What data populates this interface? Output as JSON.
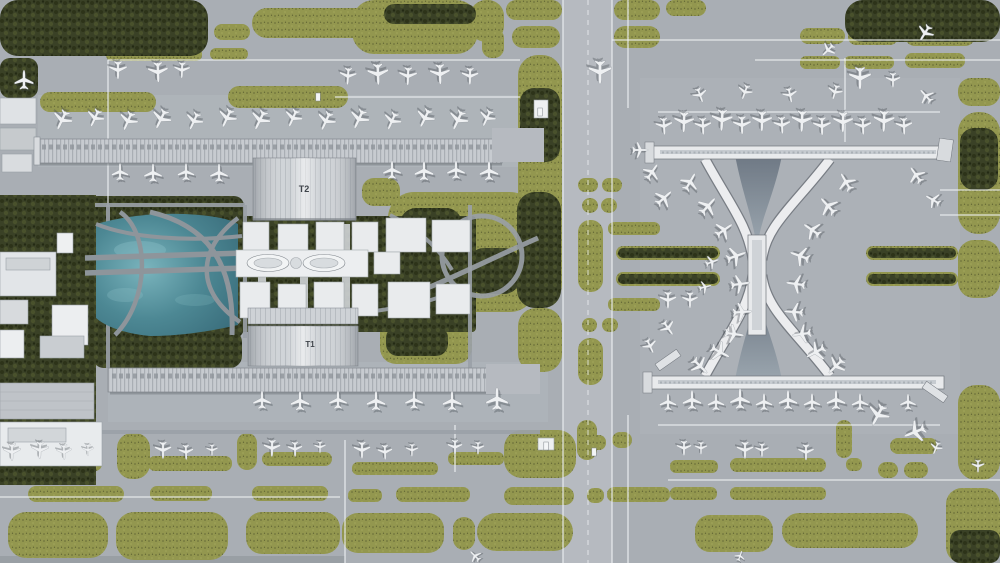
{
  "scene": {
    "title": "Aerial satellite view of airport with twin linear concourses and dog-bone terminal",
    "width": 1000,
    "height": 563
  },
  "labels": {
    "t2": "T2",
    "t1": "T1"
  },
  "colors": {
    "apron": "#a9aeb4",
    "apron_light": "#b2b7bd",
    "grass": "#93974f",
    "trees": "#3a4126",
    "water": "#4d8894",
    "terminal_roof": "#e8eaec",
    "pier_roof": "#c7cbd0",
    "taxiline": "#eef1f3",
    "road": "#9ba1a8",
    "shadow": "#70757c"
  },
  "grass_patches": [
    [
      112,
      24,
      88,
      18,
      9
    ],
    [
      214,
      24,
      36,
      16,
      8
    ],
    [
      252,
      8,
      124,
      30,
      15
    ],
    [
      106,
      48,
      96,
      13,
      6
    ],
    [
      210,
      48,
      38,
      12,
      6
    ],
    [
      40,
      92,
      116,
      20,
      10
    ],
    [
      228,
      86,
      120,
      22,
      11
    ],
    [
      352,
      0,
      126,
      54,
      22
    ],
    [
      470,
      0,
      34,
      42,
      16
    ],
    [
      482,
      28,
      22,
      30,
      10
    ],
    [
      506,
      0,
      56,
      20,
      10
    ],
    [
      614,
      0,
      46,
      20,
      10
    ],
    [
      512,
      26,
      48,
      22,
      11
    ],
    [
      614,
      26,
      46,
      22,
      11
    ],
    [
      666,
      0,
      40,
      16,
      8
    ],
    [
      800,
      28,
      45,
      16,
      8
    ],
    [
      848,
      28,
      50,
      17,
      8
    ],
    [
      905,
      26,
      70,
      20,
      10
    ],
    [
      800,
      56,
      40,
      13,
      6
    ],
    [
      844,
      56,
      50,
      13,
      6
    ],
    [
      905,
      53,
      60,
      15,
      7
    ],
    [
      518,
      55,
      44,
      250,
      20
    ],
    [
      518,
      308,
      44,
      64,
      18
    ],
    [
      578,
      178,
      20,
      14,
      7
    ],
    [
      602,
      178,
      20,
      14,
      7
    ],
    [
      582,
      198,
      16,
      15,
      8
    ],
    [
      601,
      198,
      16,
      15,
      8
    ],
    [
      578,
      220,
      25,
      72,
      12
    ],
    [
      582,
      318,
      15,
      14,
      7
    ],
    [
      602,
      318,
      16,
      14,
      7
    ],
    [
      578,
      338,
      25,
      47,
      12
    ],
    [
      608,
      222,
      52,
      13,
      6
    ],
    [
      608,
      298,
      52,
      13,
      6
    ],
    [
      362,
      178,
      38,
      28,
      12
    ],
    [
      388,
      192,
      148,
      120,
      26
    ],
    [
      380,
      312,
      92,
      52,
      16
    ],
    [
      958,
      78,
      42,
      28,
      13
    ],
    [
      958,
      112,
      42,
      122,
      20
    ],
    [
      958,
      240,
      42,
      58,
      16
    ],
    [
      958,
      385,
      42,
      95,
      18
    ],
    [
      946,
      488,
      54,
      75,
      16
    ],
    [
      890,
      438,
      48,
      16,
      8
    ],
    [
      878,
      462,
      20,
      16,
      8
    ],
    [
      904,
      462,
      24,
      16,
      8
    ],
    [
      836,
      420,
      16,
      38,
      8
    ],
    [
      577,
      420,
      20,
      40,
      10
    ],
    [
      117,
      433,
      33,
      46,
      15
    ],
    [
      237,
      433,
      20,
      37,
      10
    ],
    [
      22,
      456,
      80,
      15,
      7
    ],
    [
      148,
      456,
      84,
      15,
      7
    ],
    [
      262,
      452,
      70,
      14,
      7
    ],
    [
      352,
      462,
      86,
      13,
      6
    ],
    [
      448,
      452,
      56,
      13,
      6
    ],
    [
      670,
      460,
      48,
      13,
      6
    ],
    [
      730,
      458,
      96,
      14,
      7
    ],
    [
      846,
      458,
      16,
      13,
      6
    ],
    [
      28,
      486,
      96,
      16,
      8
    ],
    [
      150,
      486,
      62,
      15,
      7
    ],
    [
      252,
      486,
      76,
      15,
      7
    ],
    [
      348,
      489,
      34,
      13,
      6
    ],
    [
      396,
      487,
      74,
      15,
      7
    ],
    [
      504,
      487,
      70,
      18,
      9
    ],
    [
      587,
      488,
      17,
      15,
      7
    ],
    [
      607,
      487,
      63,
      15,
      7
    ],
    [
      670,
      487,
      47,
      13,
      6
    ],
    [
      730,
      487,
      96,
      13,
      6
    ],
    [
      8,
      512,
      100,
      46,
      18
    ],
    [
      116,
      512,
      112,
      48,
      18
    ],
    [
      246,
      512,
      94,
      42,
      16
    ],
    [
      342,
      513,
      102,
      40,
      16
    ],
    [
      453,
      517,
      22,
      33,
      11
    ],
    [
      477,
      513,
      96,
      38,
      19
    ],
    [
      695,
      515,
      78,
      37,
      15
    ],
    [
      782,
      513,
      136,
      35,
      17
    ],
    [
      504,
      430,
      72,
      48,
      18
    ],
    [
      588,
      435,
      18,
      15,
      7
    ],
    [
      612,
      432,
      20,
      16,
      8
    ],
    [
      616,
      246,
      104,
      14,
      7
    ],
    [
      616,
      272,
      104,
      14,
      7
    ],
    [
      866,
      246,
      92,
      14,
      7
    ],
    [
      866,
      272,
      92,
      14,
      7
    ]
  ],
  "tree_patches": [
    [
      0,
      0,
      208,
      56,
      18
    ],
    [
      845,
      0,
      155,
      42,
      18
    ],
    [
      0,
      58,
      38,
      40,
      10
    ],
    [
      384,
      4,
      92,
      20,
      10
    ],
    [
      84,
      196,
      160,
      142,
      10
    ],
    [
      92,
      330,
      150,
      38,
      12
    ],
    [
      0,
      195,
      96,
      290,
      0
    ],
    [
      520,
      88,
      40,
      74,
      14
    ],
    [
      517,
      192,
      44,
      116,
      18
    ],
    [
      400,
      208,
      62,
      42,
      16
    ],
    [
      468,
      248,
      52,
      46,
      16
    ],
    [
      394,
      268,
      46,
      36,
      12
    ],
    [
      386,
      326,
      62,
      30,
      12
    ],
    [
      960,
      128,
      38,
      62,
      14
    ],
    [
      950,
      530,
      50,
      33,
      10
    ],
    [
      618,
      248,
      100,
      10,
      5
    ],
    [
      618,
      274,
      100,
      10,
      5
    ],
    [
      868,
      248,
      88,
      10,
      5
    ],
    [
      868,
      274,
      88,
      10,
      5
    ],
    [
      226,
      216,
      250,
      116,
      4
    ]
  ],
  "taxi_lines": [
    [
      108,
      60,
      520,
      60,
      "w"
    ],
    [
      335,
      97,
      520,
      97,
      "w"
    ],
    [
      108,
      60,
      108,
      205,
      "w"
    ],
    [
      612,
      40,
      1000,
      40,
      "w"
    ],
    [
      755,
      60,
      1000,
      60,
      "w"
    ],
    [
      628,
      0,
      628,
      108,
      "w"
    ],
    [
      628,
      415,
      628,
      563,
      "w"
    ],
    [
      658,
      112,
      940,
      112,
      "w"
    ],
    [
      658,
      425,
      940,
      425,
      "w"
    ],
    [
      668,
      480,
      1000,
      480,
      "w"
    ],
    [
      0,
      497,
      340,
      497,
      "w"
    ],
    [
      345,
      440,
      345,
      563,
      "w"
    ],
    [
      455,
      425,
      455,
      472,
      "w"
    ],
    [
      845,
      58,
      845,
      142,
      "w"
    ],
    [
      563,
      0,
      563,
      563,
      "w"
    ],
    [
      612,
      0,
      612,
      563,
      "w"
    ],
    [
      940,
      190,
      1000,
      190,
      "w"
    ],
    [
      940,
      215,
      1000,
      215,
      "w"
    ],
    [
      588,
      0,
      588,
      563,
      "d"
    ],
    [
      757,
      168,
      757,
      372,
      "d"
    ],
    [
      0,
      432,
      540,
      432,
      "r"
    ],
    [
      245,
      205,
      245,
      338,
      "r"
    ],
    [
      470,
      205,
      470,
      372,
      "r"
    ],
    [
      95,
      205,
      245,
      205,
      "r"
    ],
    [
      108,
      205,
      108,
      368,
      "r"
    ]
  ],
  "airplanes": [
    [
      348,
      76,
      184,
      0.8
    ],
    [
      378,
      74,
      178,
      1.0
    ],
    [
      408,
      76,
      182,
      0.85
    ],
    [
      440,
      74,
      178,
      0.95
    ],
    [
      470,
      76,
      181,
      0.8
    ],
    [
      118,
      70,
      180,
      0.85
    ],
    [
      158,
      72,
      178,
      0.95
    ],
    [
      182,
      70,
      182,
      0.75
    ],
    [
      24,
      80,
      0,
      0.9
    ],
    [
      62,
      120,
      205,
      0.95
    ],
    [
      95,
      118,
      205,
      0.85
    ],
    [
      128,
      121,
      204,
      0.9
    ],
    [
      161,
      119,
      206,
      0.95
    ],
    [
      194,
      121,
      205,
      0.85
    ],
    [
      227,
      118,
      205,
      0.9
    ],
    [
      260,
      120,
      206,
      0.95
    ],
    [
      293,
      118,
      204,
      0.85
    ],
    [
      326,
      121,
      205,
      0.9
    ],
    [
      359,
      119,
      205,
      0.95
    ],
    [
      392,
      121,
      204,
      0.85
    ],
    [
      425,
      118,
      206,
      0.9
    ],
    [
      458,
      120,
      205,
      0.95
    ],
    [
      487,
      118,
      205,
      0.8
    ],
    [
      120,
      172,
      0,
      0.8
    ],
    [
      153,
      173,
      0,
      0.85
    ],
    [
      186,
      172,
      0,
      0.8
    ],
    [
      219,
      173,
      0,
      0.85
    ],
    [
      392,
      170,
      0,
      0.85
    ],
    [
      424,
      171,
      0,
      0.9
    ],
    [
      456,
      170,
      0,
      0.85
    ],
    [
      489,
      171,
      0,
      0.9
    ],
    [
      262,
      400,
      0,
      0.85
    ],
    [
      300,
      401,
      0,
      0.9
    ],
    [
      338,
      400,
      0,
      0.85
    ],
    [
      376,
      401,
      0,
      0.9
    ],
    [
      414,
      400,
      0,
      0.85
    ],
    [
      452,
      401,
      0,
      0.9
    ],
    [
      497,
      399,
      0,
      1.05
    ],
    [
      12,
      452,
      180,
      0.8
    ],
    [
      40,
      450,
      182,
      0.8
    ],
    [
      64,
      452,
      178,
      0.7
    ],
    [
      88,
      450,
      180,
      0.55
    ],
    [
      163,
      450,
      180,
      0.8
    ],
    [
      186,
      452,
      178,
      0.7
    ],
    [
      212,
      450,
      180,
      0.55
    ],
    [
      272,
      448,
      181,
      0.8
    ],
    [
      295,
      449,
      179,
      0.7
    ],
    [
      320,
      447,
      180,
      0.55
    ],
    [
      362,
      450,
      180,
      0.8
    ],
    [
      385,
      452,
      178,
      0.7
    ],
    [
      412,
      450,
      181,
      0.6
    ],
    [
      455,
      447,
      180,
      0.7
    ],
    [
      478,
      448,
      180,
      0.6
    ],
    [
      684,
      448,
      180,
      0.7
    ],
    [
      701,
      448,
      180,
      0.6
    ],
    [
      745,
      450,
      180,
      0.8
    ],
    [
      762,
      450,
      180,
      0.65
    ],
    [
      806,
      452,
      180,
      0.75
    ],
    [
      600,
      72,
      180,
      1.1
    ],
    [
      828,
      50,
      225,
      0.7
    ],
    [
      860,
      78,
      180,
      1.05
    ],
    [
      893,
      80,
      180,
      0.7
    ],
    [
      925,
      33,
      212,
      0.8
    ],
    [
      926,
      96,
      318,
      0.75
    ],
    [
      668,
      300,
      180,
      0.8
    ],
    [
      690,
      300,
      180,
      0.75
    ],
    [
      664,
      126,
      176,
      0.8
    ],
    [
      684,
      122,
      182,
      0.95
    ],
    [
      703,
      126,
      178,
      0.8
    ],
    [
      722,
      120,
      183,
      1.0
    ],
    [
      742,
      125,
      179,
      0.85
    ],
    [
      762,
      121,
      181,
      0.95
    ],
    [
      782,
      125,
      177,
      0.8
    ],
    [
      802,
      121,
      182,
      1.0
    ],
    [
      822,
      126,
      179,
      0.85
    ],
    [
      843,
      122,
      181,
      0.95
    ],
    [
      863,
      126,
      178,
      0.8
    ],
    [
      884,
      121,
      182,
      1.0
    ],
    [
      904,
      126,
      178,
      0.8
    ],
    [
      700,
      95,
      160,
      0.7
    ],
    [
      745,
      92,
      200,
      0.7
    ],
    [
      790,
      95,
      168,
      0.7
    ],
    [
      835,
      92,
      196,
      0.7
    ],
    [
      640,
      150,
      90,
      0.75
    ],
    [
      652,
      172,
      35,
      0.85
    ],
    [
      664,
      198,
      48,
      0.9
    ],
    [
      916,
      175,
      325,
      0.85
    ],
    [
      933,
      200,
      300,
      0.75
    ],
    [
      690,
      182,
      30,
      0.9
    ],
    [
      708,
      206,
      42,
      0.95
    ],
    [
      724,
      230,
      55,
      0.9
    ],
    [
      736,
      256,
      70,
      0.95
    ],
    [
      740,
      284,
      82,
      0.9
    ],
    [
      742,
      312,
      86,
      0.9
    ],
    [
      734,
      334,
      98,
      0.9
    ],
    [
      720,
      352,
      118,
      0.95
    ],
    [
      700,
      366,
      135,
      0.9
    ],
    [
      846,
      182,
      330,
      0.9
    ],
    [
      828,
      206,
      318,
      0.95
    ],
    [
      812,
      230,
      305,
      0.9
    ],
    [
      800,
      256,
      290,
      0.95
    ],
    [
      796,
      284,
      278,
      0.9
    ],
    [
      794,
      312,
      274,
      0.9
    ],
    [
      802,
      334,
      262,
      0.9
    ],
    [
      816,
      352,
      242,
      0.95
    ],
    [
      836,
      366,
      225,
      0.9
    ],
    [
      668,
      328,
      145,
      0.75
    ],
    [
      650,
      346,
      155,
      0.7
    ],
    [
      712,
      262,
      70,
      0.65
    ],
    [
      705,
      287,
      75,
      0.6
    ],
    [
      668,
      402,
      0,
      0.8
    ],
    [
      692,
      400,
      0,
      0.9
    ],
    [
      716,
      402,
      0,
      0.8
    ],
    [
      740,
      399,
      0,
      0.95
    ],
    [
      764,
      402,
      0,
      0.8
    ],
    [
      788,
      400,
      0,
      0.9
    ],
    [
      812,
      402,
      0,
      0.8
    ],
    [
      836,
      400,
      0,
      0.9
    ],
    [
      860,
      402,
      0,
      0.8
    ],
    [
      908,
      402,
      0,
      0.75
    ],
    [
      878,
      415,
      208,
      1.05
    ],
    [
      915,
      432,
      248,
      1.05
    ],
    [
      475,
      556,
      315,
      0.6
    ],
    [
      740,
      556,
      20,
      0.5
    ],
    [
      978,
      466,
      180,
      0.6
    ],
    [
      936,
      448,
      202,
      0.6
    ]
  ],
  "vehicles": [
    [
      540,
      112
    ],
    [
      546,
      446
    ],
    [
      594,
      452
    ],
    [
      318,
      97
    ]
  ]
}
